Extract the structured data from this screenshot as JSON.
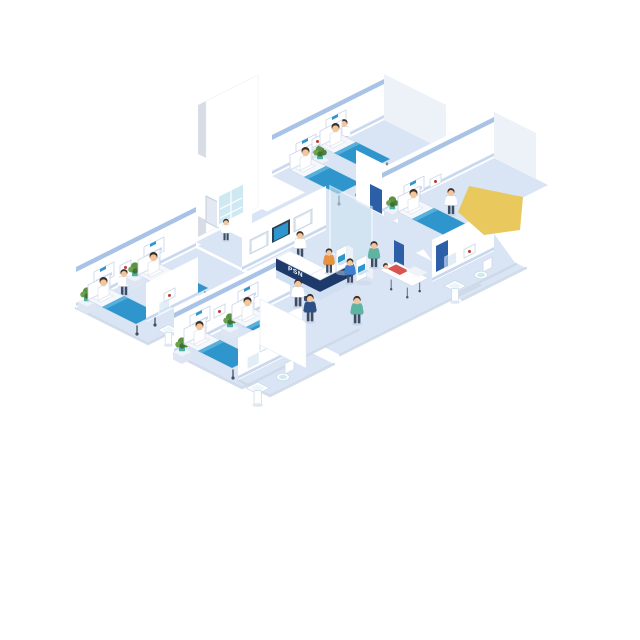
{
  "title": "Isometric hospital ward floor illustration",
  "background": "#ffffff",
  "palette": {
    "floor": "#d9e4f4",
    "wall": "#ffffff",
    "stripe": "#a9c3e6",
    "stripe2": "#c8d8ee",
    "blanket": "#2e96cc",
    "blanket-light": "#57b0dc",
    "skin": "#f2c59c",
    "hair": "#3a3028",
    "desk-navy": "#1d3a6b",
    "desk-light": "#cfe0f2",
    "glass": "#cfe4f2",
    "screen-blue": "#2e96cc",
    "yellow": "#e9c85e",
    "door": "#e3e9f3",
    "doorframe": "#c4cfde",
    "pot": "#49b0a6",
    "plant": "#5b9140",
    "coat-white": "#ffffff",
    "scrub-teal": "#5fb3a1",
    "scrub-navy": "#2e4f86",
    "visitor-orange": "#e8913f",
    "visitor-blue": "#3f7fd0",
    "patient-red": "#d9534f"
  },
  "reception": {
    "desk_label": "PSN"
  },
  "scene": {
    "setting": "hospital ward floor, isometric cutaway",
    "rooms": [
      {
        "name": "ward-room-top",
        "beds": 2,
        "patients_sitting": 2,
        "staff": [
          "doctor-white-coat"
        ],
        "plants": 1
      },
      {
        "name": "ward-room-right",
        "beds": 1,
        "patients_sitting": 1,
        "staff": [
          "doctor-white-coat"
        ],
        "plants": 1,
        "bathroom": {
          "sink": 1,
          "toilet": 1
        }
      },
      {
        "name": "ward-room-left",
        "beds": 2,
        "patients_sitting": 2,
        "staff": [
          "nurse"
        ],
        "plants": 2,
        "bathroom": {
          "sink": 1
        }
      },
      {
        "name": "ward-room-bottom",
        "beds": 2,
        "patients_sitting": 2,
        "staff": [
          "nurse"
        ],
        "plants": 2,
        "bathroom": {
          "sink": 1,
          "toilet": 1
        }
      }
    ],
    "lobby": {
      "reception_desk": true,
      "desk_label": "PSN",
      "receptionist": 1,
      "xray_wall_screens": 3,
      "checkin_kiosks": 2,
      "visitors_at_kiosks": 2,
      "stretcher_with_patient": 1,
      "nurse_pushing_stretcher": 1,
      "walking_staff": 3,
      "medicine_cabinet": 1
    },
    "props": [
      "potted-plants",
      "wall-art-frames",
      "headboard-panels",
      "pedestal-sinks",
      "toilets",
      "doors",
      "tall-wall-slab",
      "yellow-cropped-shape"
    ]
  }
}
